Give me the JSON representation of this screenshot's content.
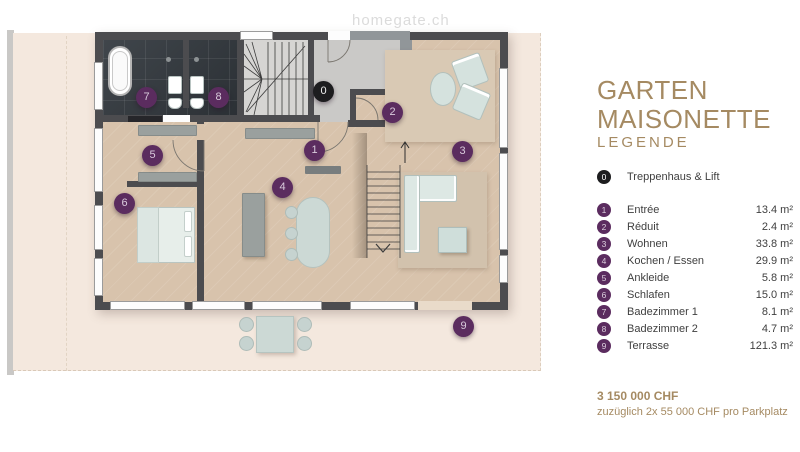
{
  "watermark": "homegate.ch",
  "panel": {
    "title_line1": "GARTEN",
    "title_line2": "MAISONETTE",
    "legend_heading": "LEGENDE",
    "stair_item": {
      "num": "0",
      "label": "Treppenhaus & Lift"
    },
    "rooms": [
      {
        "num": "1",
        "label": "Entrée",
        "area": "13.4 m²"
      },
      {
        "num": "2",
        "label": "Réduit",
        "area": "2.4 m²"
      },
      {
        "num": "3",
        "label": "Wohnen",
        "area": "33.8 m²"
      },
      {
        "num": "4",
        "label": "Kochen / Essen",
        "area": "29.9 m²"
      },
      {
        "num": "5",
        "label": "Ankleide",
        "area": "5.8 m²"
      },
      {
        "num": "6",
        "label": "Schlafen",
        "area": "15.0 m²"
      },
      {
        "num": "7",
        "label": "Badezimmer 1",
        "area": "8.1 m²"
      },
      {
        "num": "8",
        "label": "Badezimmer 2",
        "area": "4.7 m²"
      },
      {
        "num": "9",
        "label": "Terrasse",
        "area": "121.3 m²"
      }
    ],
    "price": "3 150 000 CHF",
    "price_note": "zuzüglich 2x 55 000 CHF pro Parkplatz"
  },
  "plan": {
    "colors": {
      "accent_purple": "#5b2c5f",
      "marker_black": "#1d1d1f",
      "title_tan": "#a58a62",
      "wall": "#4c4c4f",
      "wood_floor": "#d8c3ac",
      "terrace": "#f4e8de"
    }
  }
}
